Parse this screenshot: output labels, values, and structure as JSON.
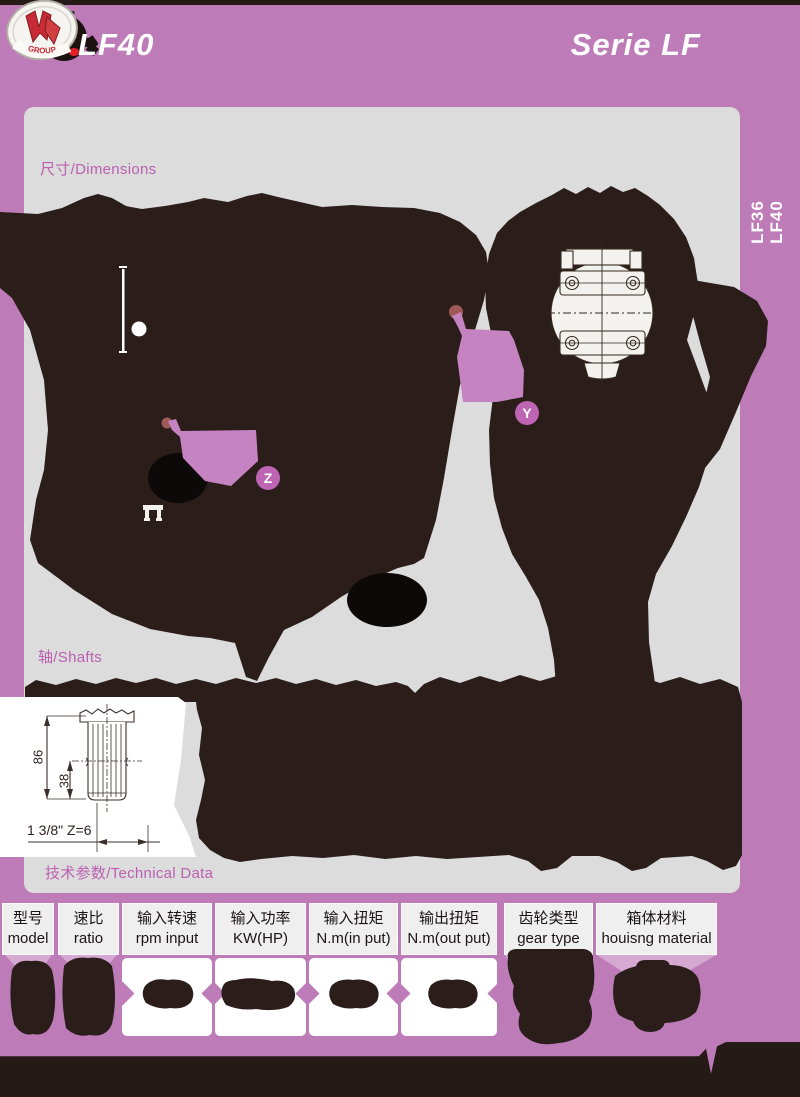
{
  "header": {
    "model": "LF40",
    "series": "Serie LF",
    "logo_text": "GROUP"
  },
  "side_tab": {
    "line1": "LF36",
    "line2": "LF40"
  },
  "sections": {
    "dimensions": "尺寸/Dimensions",
    "shafts": "轴/Shafts",
    "technical": "技术参数/Technical Data"
  },
  "markers": {
    "y": "Y",
    "z": "Z"
  },
  "shaft_drawing": {
    "dim_total": "86",
    "dim_spline": "38",
    "spec": "1 3/8\" Z=6"
  },
  "table": {
    "columns": [
      {
        "zh": "型号",
        "en": "model"
      },
      {
        "zh": "速比",
        "en": "ratio"
      },
      {
        "zh": "输入转速",
        "en": "rpm input"
      },
      {
        "zh": "输入功率",
        "en": "KW(HP)"
      },
      {
        "zh": "输入扭矩",
        "en": "N.m(in put)"
      },
      {
        "zh": "输出扭矩",
        "en": "N.m(out put)"
      },
      {
        "zh": "齿轮类型",
        "en": "gear type"
      },
      {
        "zh": "箱体材料",
        "en": "houisng material"
      }
    ]
  },
  "colors": {
    "page_bg": "#bd7cb8",
    "panel_bg": "#dcdcdd",
    "ink": "#2a1d1a",
    "highlight_pink": "#c583c1",
    "marker_pink": "#bd64b2",
    "label_pink": "#bb5fb0",
    "header_cell_bg": "#f0eff0",
    "trapezoid_pink": "#d5a9d2",
    "teardrop_red": "#9f5a58"
  }
}
